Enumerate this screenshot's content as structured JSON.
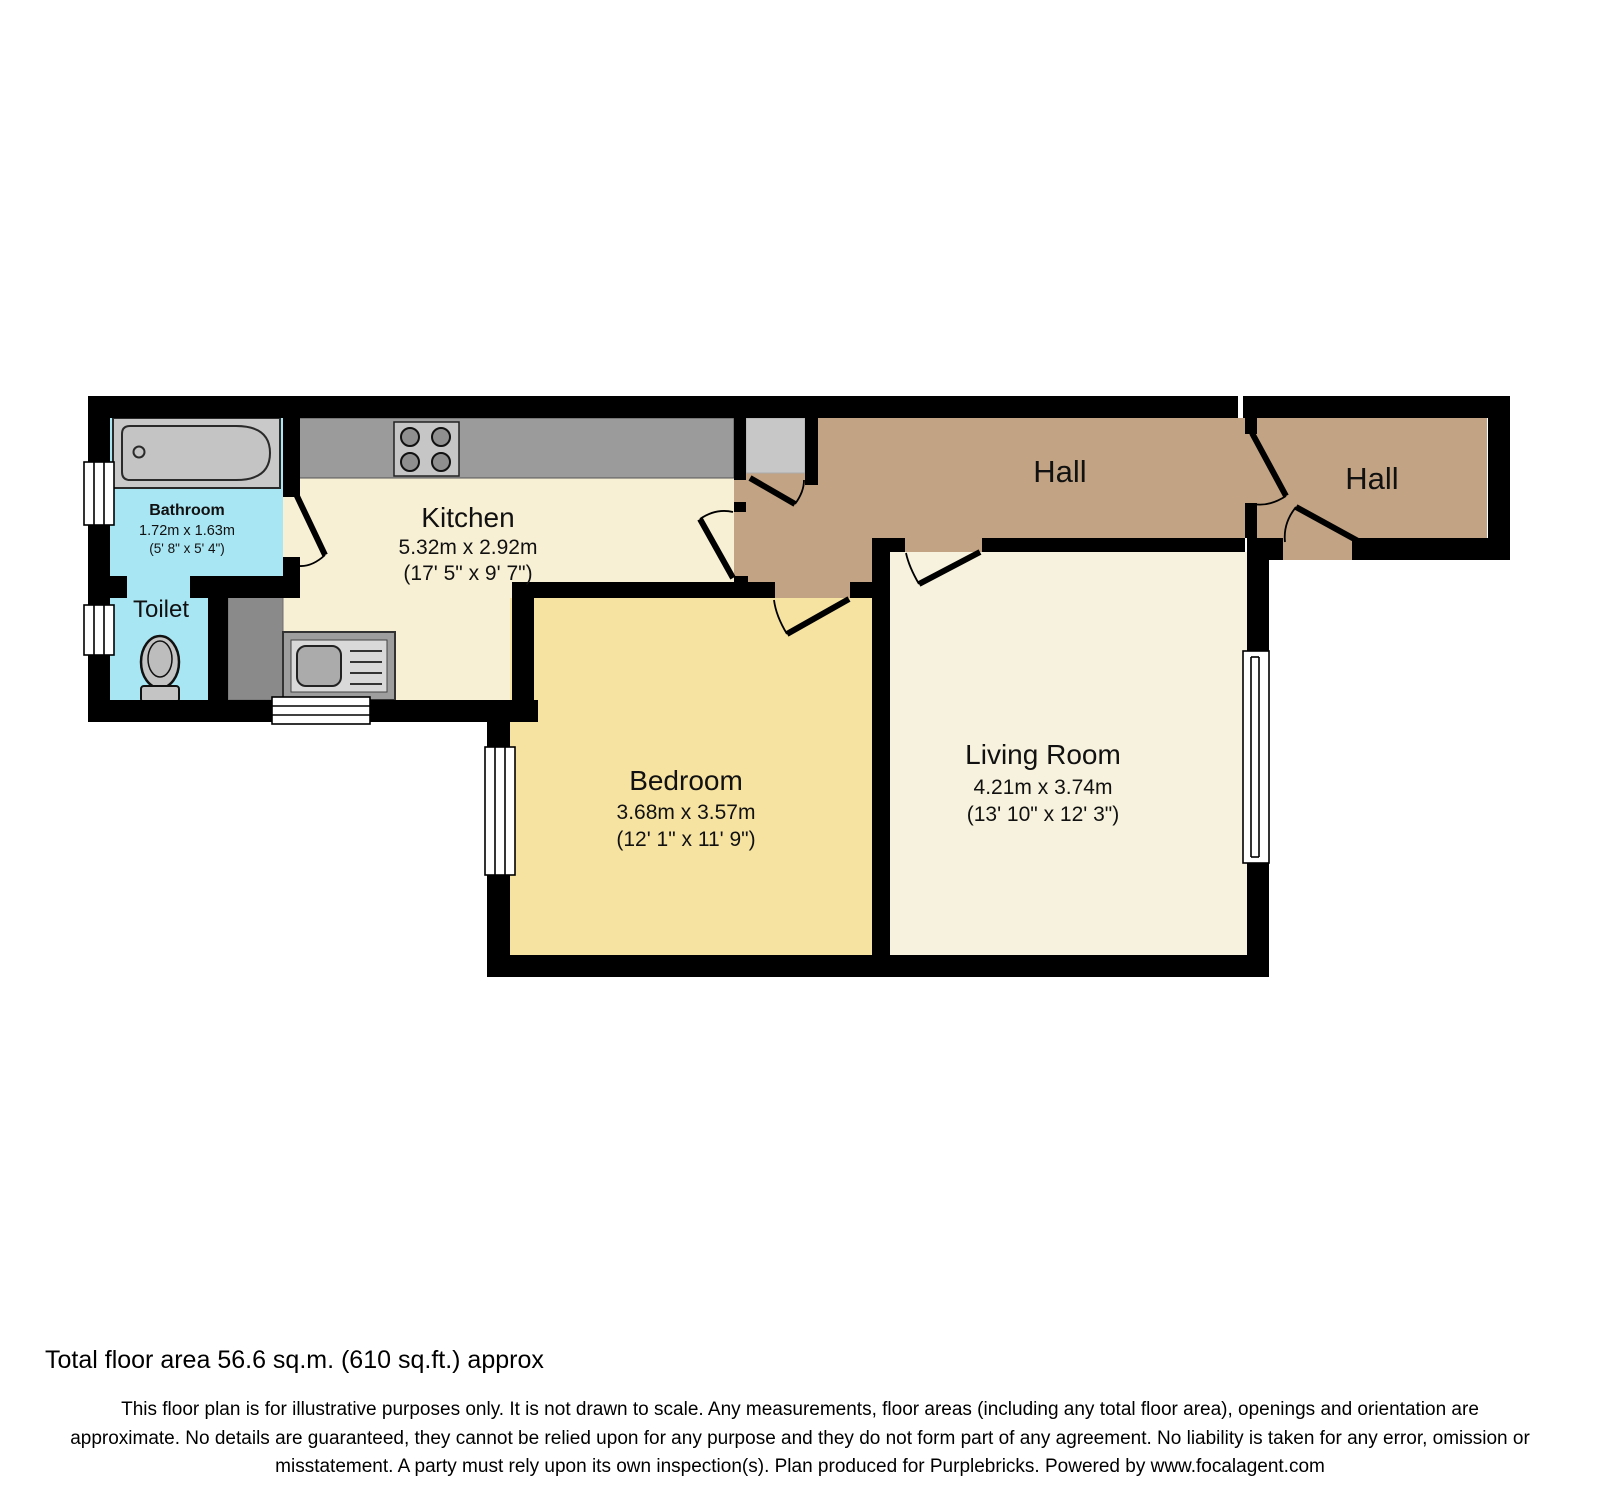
{
  "plan": {
    "rooms": {
      "bathroom": {
        "name": "Bathroom",
        "dims_m": "1.72m x 1.63m",
        "dims_ft": "(5' 8\" x 5' 4\")"
      },
      "toilet": {
        "name": "Toilet"
      },
      "kitchen": {
        "name": "Kitchen",
        "dims_m": "5.32m x 2.92m",
        "dims_ft": "(17' 5\" x 9' 7\")"
      },
      "bedroom": {
        "name": "Bedroom",
        "dims_m": "3.68m x 3.57m",
        "dims_ft": "(12' 1\" x 11' 9\")"
      },
      "living_room": {
        "name": "Living Room",
        "dims_m": "4.21m x 3.74m",
        "dims_ft": "(13' 10\" x 12' 3\")"
      },
      "hall_main": {
        "name": "Hall"
      },
      "hall_entry": {
        "name": "Hall"
      }
    },
    "colors": {
      "wall": "#000000",
      "wet_room_floor": "#A9E6F3",
      "kitchen_floor": "#F8F0D5",
      "bedroom_floor": "#F6E3A2",
      "living_floor": "#F7F2DD",
      "hall_floor": "#C2A383",
      "counter": "#9B9B9B",
      "fixture": "#C9C9C9",
      "unit_dark": "#8A8A8A",
      "cupboard": "#C7C7C7"
    }
  },
  "footer": {
    "total_area": "Total floor area 56.6 sq.m. (610 sq.ft.) approx",
    "disclaimer": "This floor plan is for illustrative purposes only. It is not drawn to scale. Any measurements, floor areas (including any total floor area), openings and orientation are approximate. No details are guaranteed, they cannot be relied upon for any purpose and they do not form part of any agreement. No liability is taken for any error, omission or misstatement. A party must rely upon its own inspection(s). Plan produced for Purplebricks. Powered by www.focalagent.com"
  }
}
